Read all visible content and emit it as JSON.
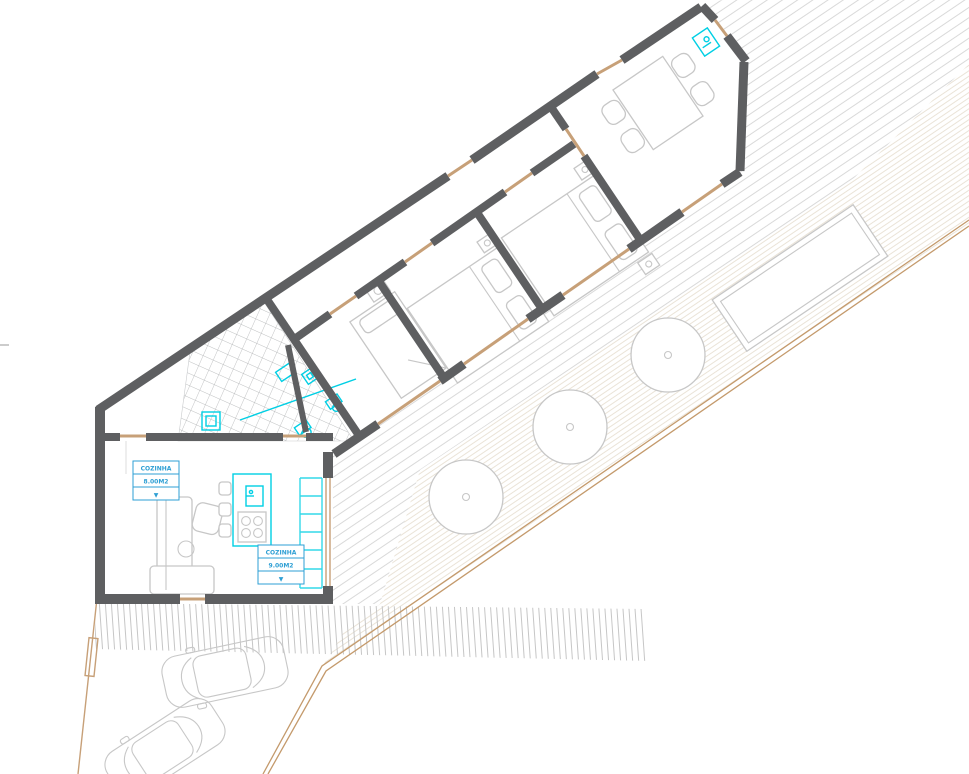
{
  "labels": {
    "living": {
      "row1": "COZINHA",
      "row2": "8.00M2",
      "row3": "▼"
    },
    "kitchen": {
      "row1": "COZINHA",
      "row2": "9.00M2",
      "row3": "▼"
    }
  },
  "colors": {
    "wall": "#5e5f61",
    "accent": "#00cfe4",
    "labelBlue": "#2e9fd4",
    "tan": "#c7a078",
    "boundary": "#c49a6c",
    "furniture": "#c7c7c7",
    "tile": "#a9abad",
    "hatchFine": "#eae3d7",
    "hatchDeck": "#d9d9d9",
    "stripe": "#c6c6c6",
    "paper": "#ffffff"
  }
}
